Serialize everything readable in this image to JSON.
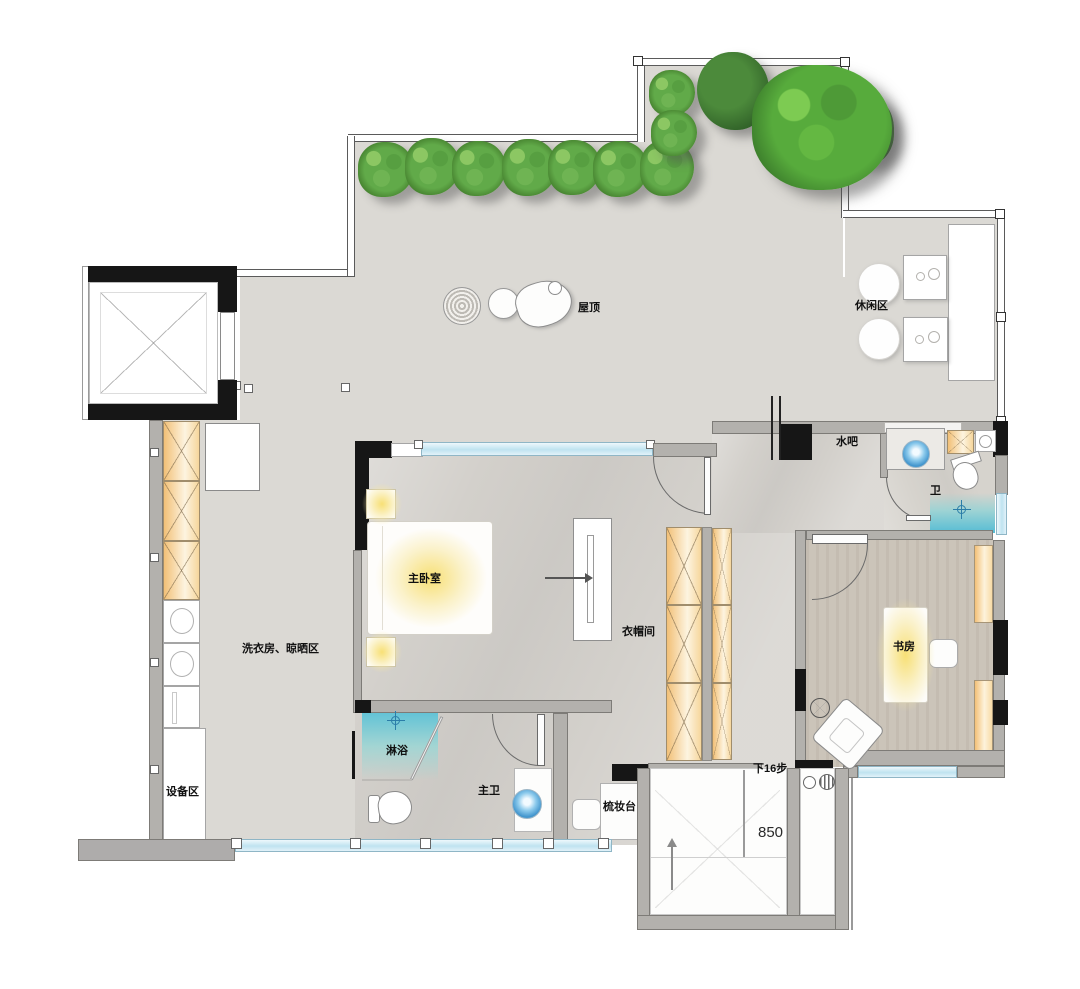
{
  "title": "penthouse-roof-floor-plan",
  "labels": {
    "roof": "屋顶",
    "leisure_area": "休闲区",
    "water_bar": "水吧",
    "wc": "卫",
    "master_bedroom": "主卧室",
    "cloakroom": "衣帽间",
    "study": "书房",
    "laundry": "洗衣房、晾晒区",
    "shower": "淋浴",
    "master_bath": "主卫",
    "dressing_table": "梳妆台",
    "equipment_area": "设备区",
    "stairs_down": "下16步",
    "stair_width": "850"
  },
  "colors": {
    "terrace_floor": "#dbd9d4",
    "indoor_marble": "#d3d0cb",
    "study_wood": "#cbc4b9",
    "wall_gray": "#b3b1ad",
    "structure_black": "#161616",
    "window_glass": "#bfe3f0",
    "cabinet_orange": "#f3c077",
    "light_glow": "#f7de6e",
    "sink_water": "#3f93cc",
    "tree_green": "#57ab3c"
  }
}
